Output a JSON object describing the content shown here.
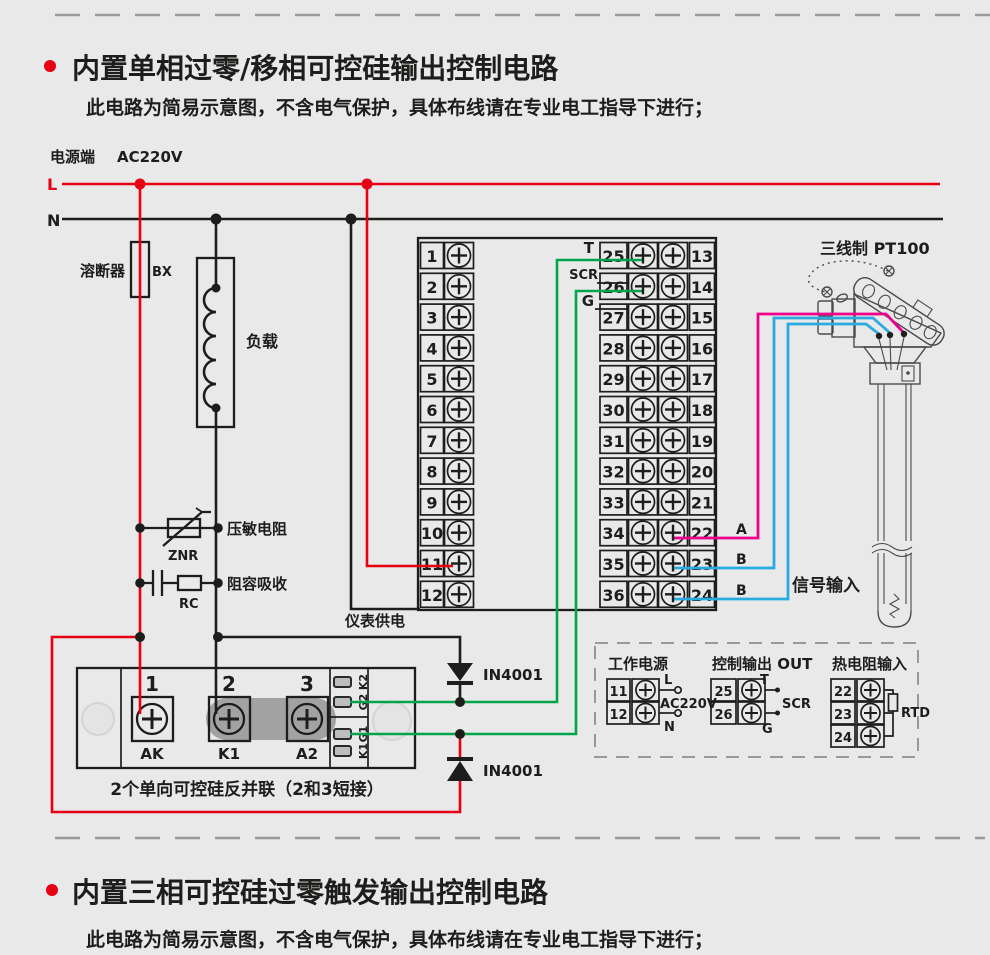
{
  "section1": {
    "title": "内置单相过零/移相可控硅输出控制电路",
    "subtitle": "此电路为简易示意图，不含电气保护，具体布线请在专业电工指导下进行；"
  },
  "section2": {
    "title": "内置三相可控硅过零触发输出控制电路",
    "subtitle": "此电路为简易示意图，不含电气保护，具体布线请在专业电工指导下进行；"
  },
  "power": {
    "terminal_label": "电源端",
    "voltage": "AC220V",
    "live": "L",
    "neutral": "N"
  },
  "fuse": {
    "name": "溶断器",
    "code": "BX"
  },
  "load": {
    "name": "负载"
  },
  "varistor": {
    "name": "压敏电阻",
    "code": "ZNR"
  },
  "snubber": {
    "name": "阻容吸收",
    "code": "RC"
  },
  "meter_supply": {
    "label": "仪表供电"
  },
  "terminal_block": {
    "left_numbers": [
      "1",
      "2",
      "3",
      "4",
      "5",
      "6",
      "7",
      "8",
      "9",
      "10",
      "11",
      "12"
    ],
    "middle_numbers": [
      "25",
      "26",
      "27",
      "28",
      "29",
      "30",
      "31",
      "32",
      "33",
      "34",
      "35",
      "36"
    ],
    "right_numbers": [
      "13",
      "14",
      "15",
      "16",
      "17",
      "18",
      "19",
      "20",
      "21",
      "22",
      "23",
      "24"
    ],
    "output_labels": {
      "t": "T",
      "scr": "SCR",
      "g": "G"
    }
  },
  "diodes": {
    "top": "IN4001",
    "bottom": "IN4001"
  },
  "scr_module": {
    "terminal_numbers": [
      "1",
      "2",
      "3"
    ],
    "terminal_names": [
      "AK",
      "K1",
      "A2"
    ],
    "pin_labels": [
      "K2",
      "G2",
      "G1",
      "K1"
    ],
    "caption": "2个单向可控硅反并联（2和3短接）"
  },
  "sensor": {
    "title": "三线制 PT100",
    "wire_labels": [
      "A",
      "B",
      "B"
    ],
    "signal_label": "信号输入"
  },
  "legend": {
    "power": {
      "title": "工作电源",
      "rows": [
        "11",
        "12"
      ],
      "live": "L",
      "voltage": "AC220V",
      "neutral": "N"
    },
    "output": {
      "title": "控制输出 OUT",
      "rows": [
        "25",
        "26"
      ],
      "t": "T",
      "scr": "SCR",
      "g": "G"
    },
    "rtd": {
      "title": "热电阻输入",
      "rows": [
        "22",
        "23",
        "24"
      ],
      "label": "RTD"
    }
  },
  "colors": {
    "background": "#e9e9e9",
    "line_black": "#1d1d1b",
    "live_red": "#e60012",
    "gate_green": "#00a44a",
    "sensor_pink": "#ec008c",
    "sensor_blue": "#29abe2"
  }
}
